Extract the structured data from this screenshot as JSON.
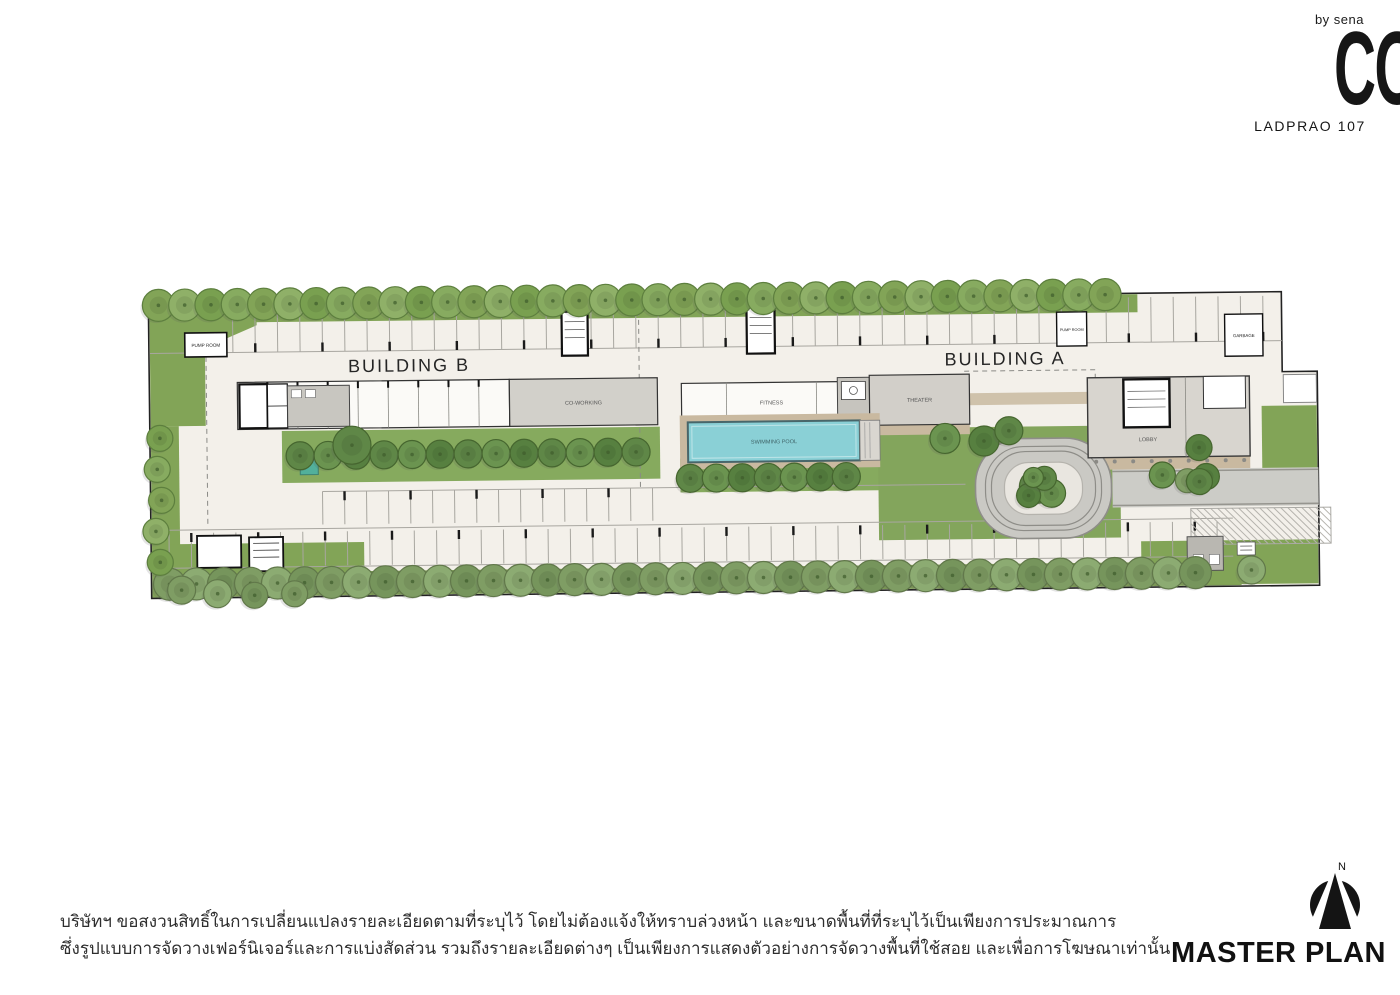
{
  "brand": {
    "byline": "by sena",
    "logo": "COZI",
    "project": "LADPRAO 107"
  },
  "plan": {
    "labels": {
      "building_b": "BUILDING B",
      "building_a": "BUILDING A",
      "swimming_pool": "SWIMMING POOL",
      "fitness": "FITNESS",
      "theater": "THEATER",
      "coworking": "CO-WORKING",
      "lobby": "LOBBY",
      "pump_room": "PUMP ROOM",
      "garbage": "GARBAGE"
    }
  },
  "footer": {
    "disclaimer_line1": "บริษัทฯ ขอสงวนสิทธิ์ในการเปลี่ยนแปลงรายละเอียดตามที่ระบุไว้ โดยไม่ต้องแจ้งให้ทราบล่วงหน้า และขนาดพื้นที่ที่ระบุไว้เป็นเพียงการประมาณการ",
    "disclaimer_line2": "ซึ่งรูปแบบการจัดวางเฟอร์นิเจอร์และการแบ่งสัดส่วน รวมถึงรายละเอียดต่างๆ เป็นเพียงการแสดงตัวอย่างการจัดวางพื้นที่ใช้สอย และเพื่อการโฆษณาเท่านั้น",
    "title": "MASTER PLAN",
    "compass_label": "N"
  },
  "colors": {
    "site_fill": "#f3f0ea",
    "green": "#82a457",
    "pool": "#8ad0d6",
    "building_gray": "#d2d0ca",
    "accent_black": "#1a1a1a"
  }
}
